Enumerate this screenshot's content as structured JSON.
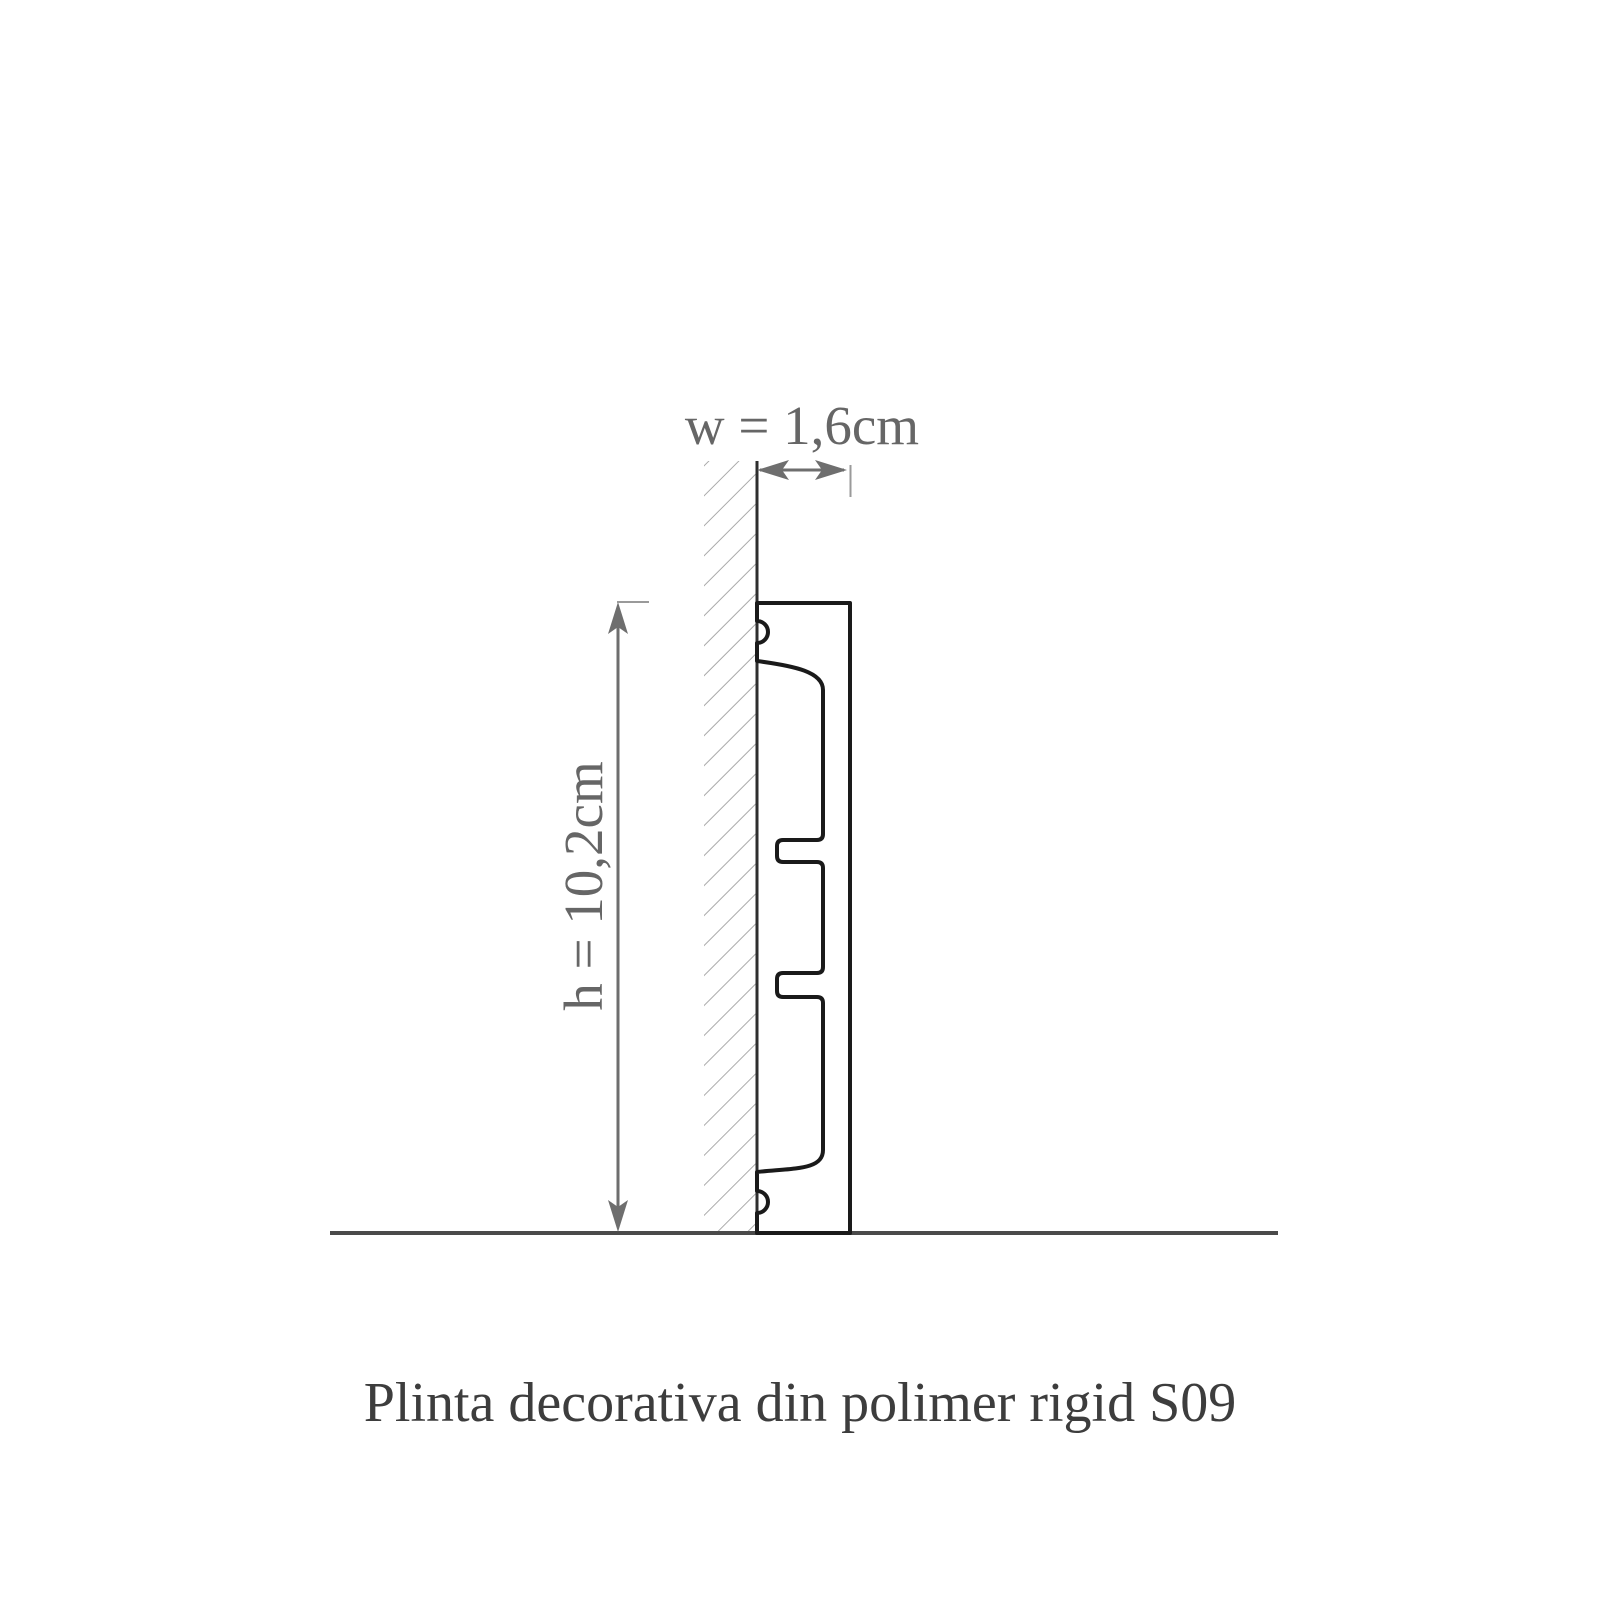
{
  "diagram": {
    "caption": "Plinta decorativa din polimer rigid S09",
    "product_code": "S09",
    "width_dimension": {
      "label": "w = 1,6cm",
      "value": "1,6",
      "unit": "cm"
    },
    "height_dimension": {
      "label": "h = 10,2cm",
      "value": "10,2",
      "unit": "cm"
    },
    "colors": {
      "background": "#ffffff",
      "profile_line": "#1a1a1a",
      "wall_line": "#2e2e2e",
      "floor_line": "#4a4a4a",
      "hatch_line": "#9b9b9b",
      "dimension_line": "#6e6e6e",
      "extension_tick": "#9a9a9a",
      "dimension_text": "#666666",
      "caption_text": "#3d3d3d"
    }
  }
}
